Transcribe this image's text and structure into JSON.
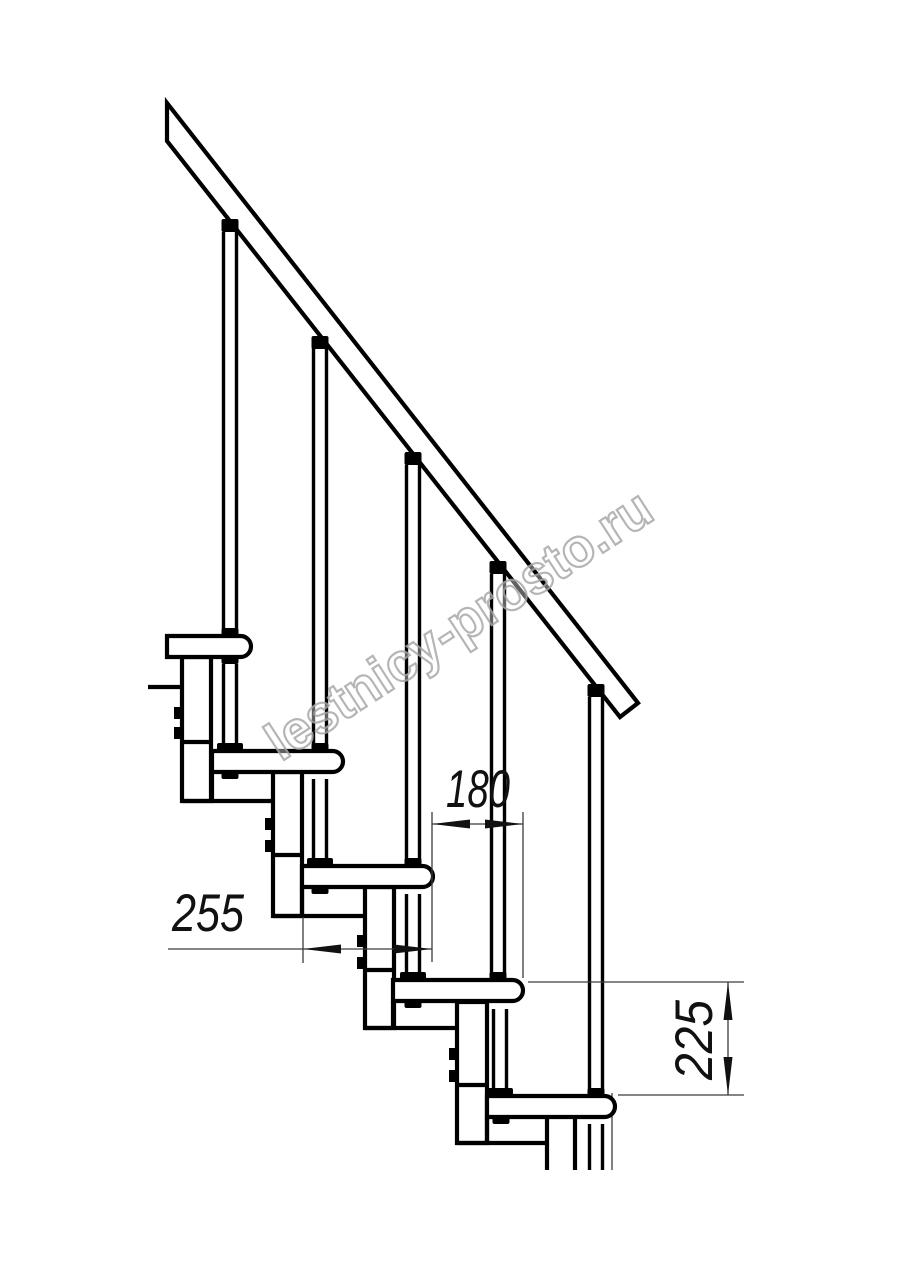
{
  "drawing": {
    "type": "staircase-side-elevation",
    "watermark": "lestnicy-prosto.ru",
    "dimensions": [
      {
        "id": "going",
        "value": "255",
        "orientation": "horizontal"
      },
      {
        "id": "spacing",
        "value": "180",
        "orientation": "horizontal"
      },
      {
        "id": "rise",
        "value": "225",
        "orientation": "vertical"
      }
    ],
    "colors": {
      "line": "#000000",
      "dimension": "#3c3c3c",
      "watermark": "#a9a9a9",
      "background": "#ffffff"
    }
  }
}
